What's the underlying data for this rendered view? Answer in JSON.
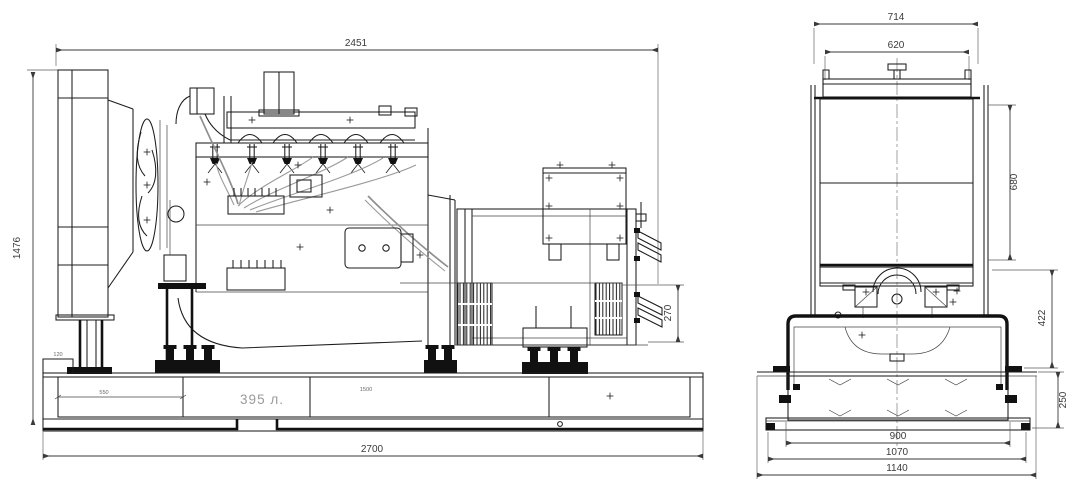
{
  "meta": {
    "background_color": "#ffffff",
    "line_color": "#1c1c1c",
    "dim_color": "#3a3a3a",
    "faint_color": "#9a9a9a"
  },
  "left_view": {
    "dims": {
      "overall_length": "2451",
      "overall_height": "1476",
      "alternator_mount_height": "270",
      "base_length": "2700",
      "tank_bay_left": "550",
      "tank_bay_right": "1500",
      "end_offset": "120",
      "tank_capacity": "395 л."
    }
  },
  "right_view": {
    "dims": {
      "overall_width": "714",
      "core_width": "620",
      "radiator_height": "680",
      "frame_height": "422",
      "base_height": "250",
      "skid_width": "900",
      "channel_width": "1070",
      "base_plate_width": "1140"
    }
  }
}
